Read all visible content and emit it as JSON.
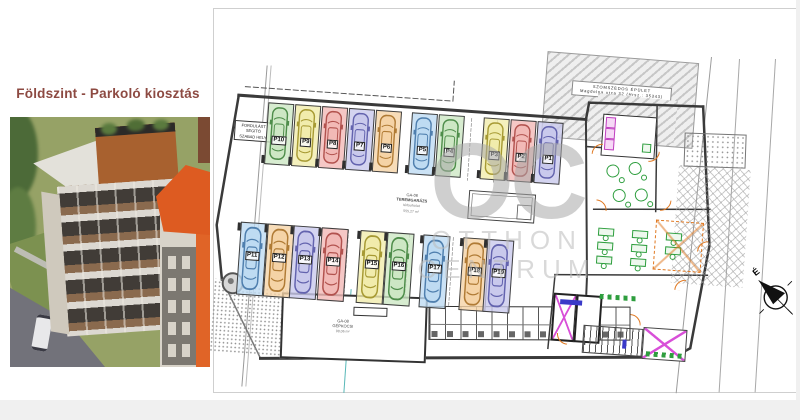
{
  "header": {
    "title": "Földszint - Parkoló kiosztás"
  },
  "watermark": {
    "monogram": "OC",
    "word1": "OTTHON",
    "word2": "CENTRUM"
  },
  "colors": {
    "title_text": "#8d4a42",
    "walls": "#3a3a3a",
    "door_accent": "#e07820",
    "furniture_green": "#2e9e3e",
    "fixture_magenta": "#cc4ecc",
    "watermark_gray": "#b3b3b3"
  },
  "plan": {
    "turning_area_label": {
      "l1": "FORDULÁST",
      "l2": "SEGÍTŐ",
      "l3": "SZABAD HELY"
    },
    "neighbor_building": {
      "l1": "SZOMSZÉDOS ÉPÜLET",
      "l2": "Magdolna utca 32 (Hrsz.: 35343)"
    },
    "garage_label": {
      "code": "GA-06",
      "name": "TEREMGARÁZS",
      "sub1": "térburkolat",
      "sub2": "555,27 m²"
    },
    "car_room_label": {
      "code": "GA-08",
      "name": "GÉPKOCSI",
      "sub1": "98,06 m²"
    },
    "compass_north": "É",
    "stall_colors": {
      "green": {
        "fill": "#cde7c4",
        "stroke": "#4e8d4a"
      },
      "yellow": {
        "fill": "#f1ecac",
        "stroke": "#a79a33"
      },
      "red": {
        "fill": "#f2b9b6",
        "stroke": "#b2524e"
      },
      "lavender": {
        "fill": "#c9c9ec",
        "stroke": "#6363ae"
      },
      "orange": {
        "fill": "#f5d3a6",
        "stroke": "#b07b35"
      },
      "blue": {
        "fill": "#bedbf2",
        "stroke": "#4f7fae"
      }
    },
    "stalls_top": [
      {
        "id": "P10",
        "color": "green"
      },
      {
        "id": "P9",
        "color": "yellow"
      },
      {
        "id": "P8",
        "color": "red"
      },
      {
        "id": "P7",
        "color": "lavender"
      },
      {
        "id": "P6",
        "color": "orange"
      },
      {
        "id": "P5",
        "color": "blue"
      },
      {
        "id": "P4",
        "color": "green"
      },
      {
        "id": "P3",
        "color": "yellow"
      },
      {
        "id": "P2",
        "color": "red"
      },
      {
        "id": "P1",
        "color": "lavender"
      }
    ],
    "stalls_bottom": [
      {
        "id": "P11",
        "color": "blue"
      },
      {
        "id": "P12",
        "color": "orange"
      },
      {
        "id": "P13",
        "color": "lavender"
      },
      {
        "id": "P14",
        "color": "red"
      },
      {
        "id": "P15",
        "color": "yellow"
      },
      {
        "id": "P16",
        "color": "green"
      },
      {
        "id": "P17",
        "color": "blue"
      },
      {
        "id": "P18",
        "color": "orange"
      },
      {
        "id": "P19",
        "color": "lavender"
      }
    ]
  }
}
